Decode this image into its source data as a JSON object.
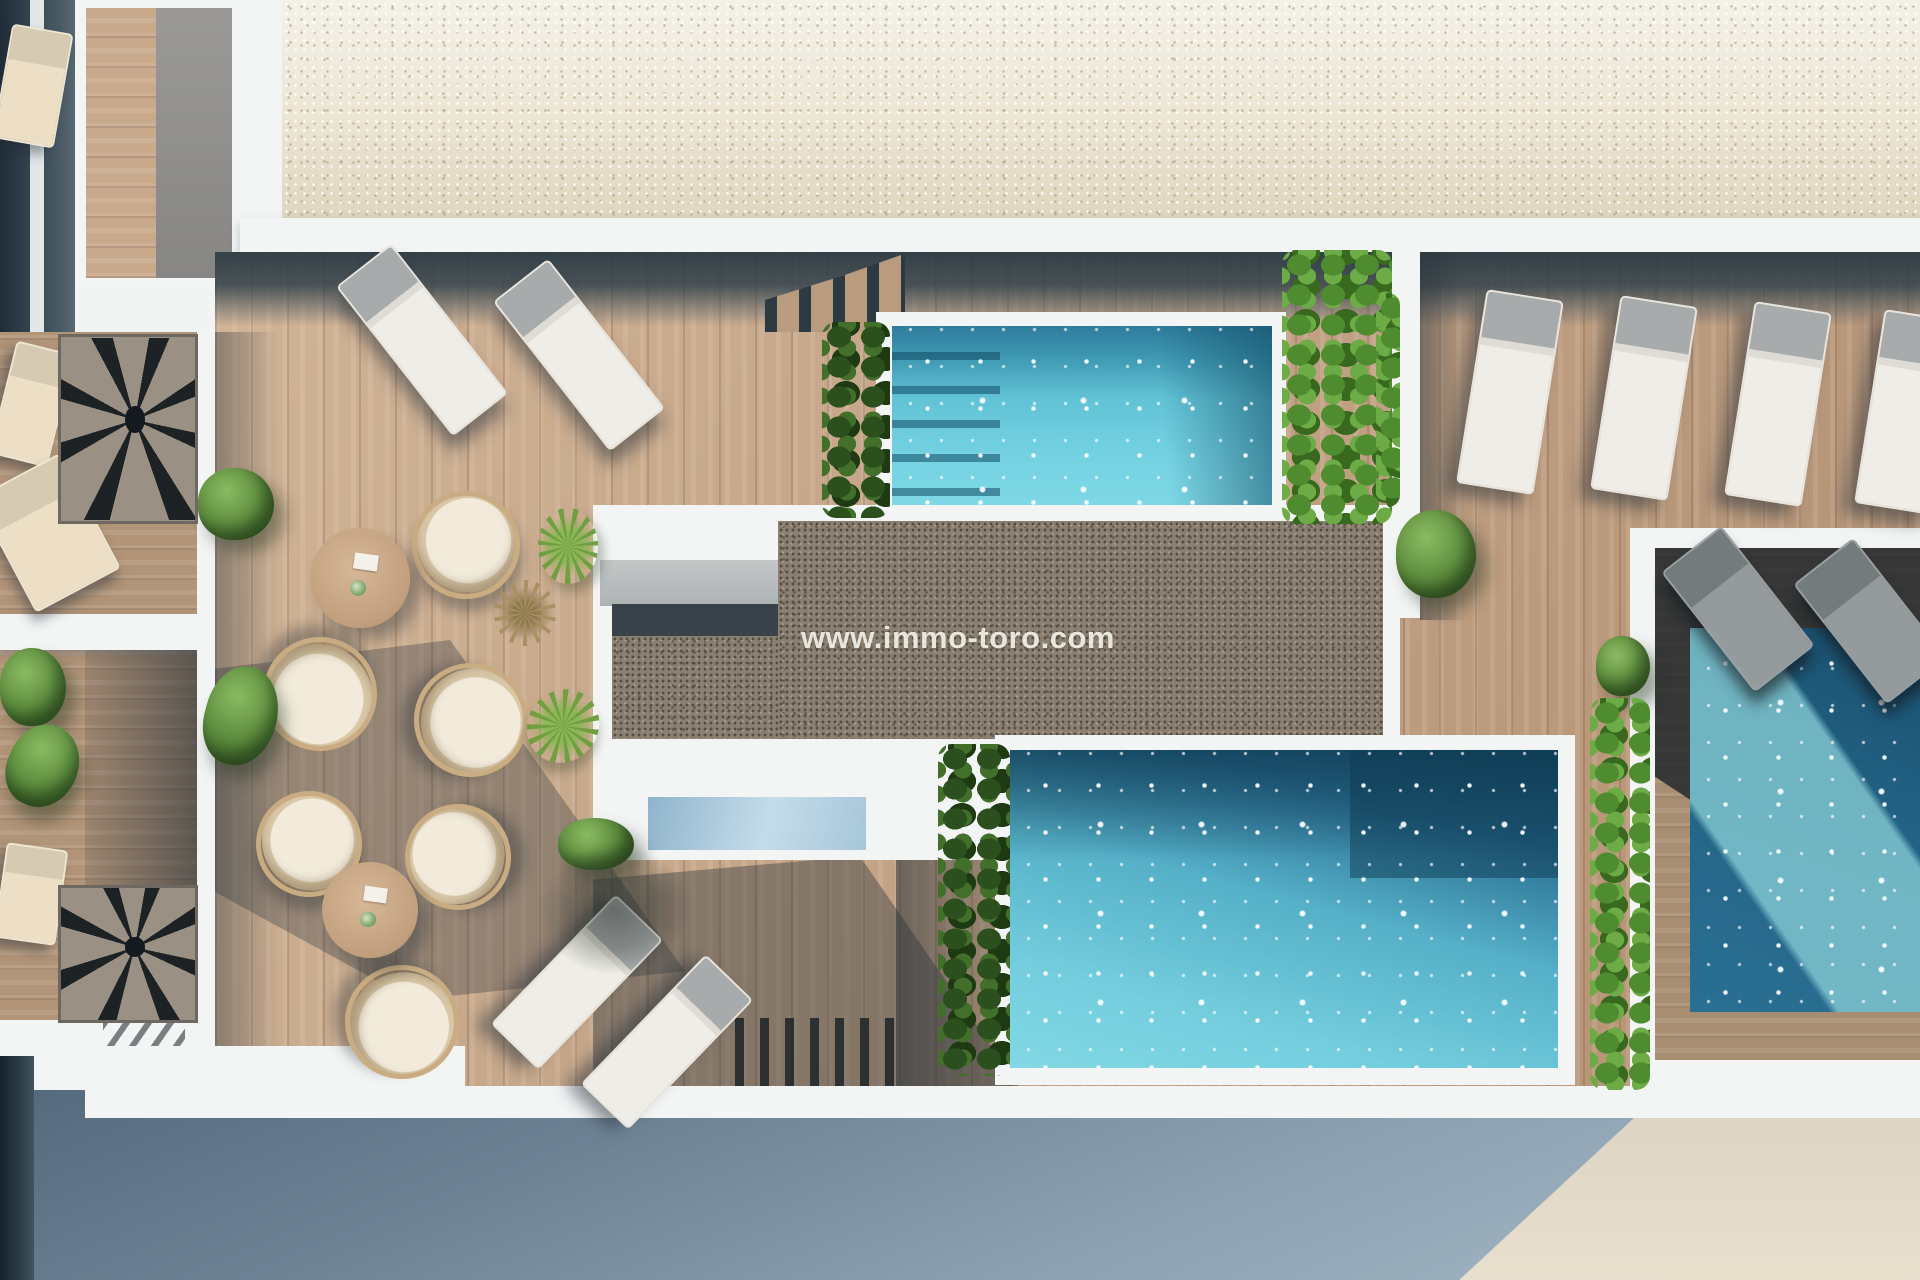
{
  "watermark": {
    "text": "www.immo-toro.com",
    "color": "#f0eee6"
  },
  "scene": {
    "type": "aerial-architectural-render",
    "subject": "rooftop terrace of an apartment building with three pools, timber sun deck, lounge furniture and planting",
    "palette": {
      "roof_gravel": "#e9e2d2",
      "terrace_gravel": "#8b8071",
      "deck_wood": "#bf9d7e",
      "white_walls": "#f3f5f5",
      "pool_light": "#74d2e2",
      "pool_mid": "#55b0c8",
      "pool_dark": "#1d5a7c",
      "shadow_blue": "#37454e",
      "street": "#7b90a1",
      "street_sunlit": "#e2d9c7",
      "plant_green": "#5a8a3c"
    },
    "counts": {
      "pools": 3,
      "sun_loungers": 14,
      "rattan_chairs": 6,
      "round_tables": 2,
      "spiral_staircases": 2
    },
    "furniture": [
      {
        "type": "lounger",
        "x": 387,
        "y": 245,
        "w": 66,
        "h": 186,
        "r": -38
      },
      {
        "type": "lounger",
        "x": 544,
        "y": 260,
        "w": 66,
        "h": 186,
        "r": -38
      },
      {
        "type": "lounger",
        "x": 1471,
        "y": 294,
        "w": 74,
        "h": 192,
        "r": 9
      },
      {
        "type": "lounger",
        "x": 1605,
        "y": 300,
        "w": 74,
        "h": 192,
        "r": 9
      },
      {
        "type": "lounger",
        "x": 1739,
        "y": 306,
        "w": 74,
        "h": 192,
        "r": 9
      },
      {
        "type": "lounger",
        "x": 1869,
        "y": 314,
        "w": 74,
        "h": 192,
        "r": 9
      },
      {
        "type": "lounger",
        "x": 544,
        "y": 892,
        "w": 62,
        "h": 176,
        "r": 44
      },
      {
        "type": "lounger",
        "x": 634,
        "y": 952,
        "w": 62,
        "h": 176,
        "r": 44
      },
      {
        "type": "lounger-gray",
        "x": 1700,
        "y": 533,
        "w": 72,
        "h": 148,
        "r": -38
      },
      {
        "type": "lounger-gray",
        "x": 1832,
        "y": 545,
        "w": 72,
        "h": 148,
        "r": -38
      },
      {
        "type": "lounger-beige",
        "x": 2,
        "y": 28,
        "w": 58,
        "h": 112,
        "r": 10
      },
      {
        "type": "lounger-beige",
        "x": 2,
        "y": 346,
        "w": 56,
        "h": 112,
        "r": 14
      },
      {
        "type": "lounger-beige",
        "x": 0,
        "y": 468,
        "w": 92,
        "h": 126,
        "r": -28
      },
      {
        "type": "lounger-beige",
        "x": 0,
        "y": 846,
        "w": 58,
        "h": 92,
        "r": 8
      },
      {
        "type": "chair",
        "x": 412,
        "y": 491,
        "w": 98,
        "h": 98,
        "r": 30
      },
      {
        "type": "chair",
        "x": 263,
        "y": 637,
        "w": 104,
        "h": 104,
        "r": 200
      },
      {
        "type": "chair",
        "x": 414,
        "y": 663,
        "w": 104,
        "h": 104,
        "r": 120
      },
      {
        "type": "chair",
        "x": 256,
        "y": 791,
        "w": 96,
        "h": 96,
        "r": 40
      },
      {
        "type": "chair",
        "x": 405,
        "y": 804,
        "w": 96,
        "h": 96,
        "r": 310
      },
      {
        "type": "chair",
        "x": 345,
        "y": 965,
        "w": 104,
        "h": 104,
        "r": 160
      },
      {
        "type": "table",
        "x": 310,
        "y": 528,
        "w": 100,
        "h": 100,
        "r": 0
      },
      {
        "type": "table",
        "x": 322,
        "y": 862,
        "w": 96,
        "h": 96,
        "r": 0
      },
      {
        "type": "bush",
        "x": 198,
        "y": 468,
        "w": 76,
        "h": 72,
        "r": 0
      },
      {
        "type": "bush",
        "x": 205,
        "y": 666,
        "w": 72,
        "h": 100,
        "r": 15
      },
      {
        "type": "bush",
        "x": 558,
        "y": 818,
        "w": 76,
        "h": 52,
        "r": 0
      },
      {
        "type": "bush",
        "x": 1396,
        "y": 510,
        "w": 80,
        "h": 88,
        "r": 0
      },
      {
        "type": "bush",
        "x": 1596,
        "y": 636,
        "w": 54,
        "h": 60,
        "r": 0
      },
      {
        "type": "bush",
        "x": 0,
        "y": 648,
        "w": 66,
        "h": 78,
        "r": 0
      },
      {
        "type": "bush",
        "x": 8,
        "y": 724,
        "w": 70,
        "h": 84,
        "r": 25
      },
      {
        "type": "yucca",
        "x": 538,
        "y": 508,
        "w": 60,
        "h": 76,
        "r": 0
      },
      {
        "type": "yucca",
        "x": 528,
        "y": 688,
        "w": 70,
        "h": 76,
        "r": 40
      },
      {
        "type": "grass",
        "x": 494,
        "y": 580,
        "w": 62,
        "h": 66,
        "r": 0
      },
      {
        "type": "vine-dark",
        "x": 822,
        "y": 322,
        "w": 68,
        "h": 196,
        "r": 0
      },
      {
        "type": "vine",
        "x": 1282,
        "y": 250,
        "w": 110,
        "h": 274,
        "r": 0
      },
      {
        "type": "vine",
        "x": 1376,
        "y": 293,
        "w": 24,
        "h": 214,
        "r": 0
      },
      {
        "type": "vine-dark",
        "x": 938,
        "y": 744,
        "w": 72,
        "h": 332,
        "r": 0
      },
      {
        "type": "vine",
        "x": 1590,
        "y": 698,
        "w": 60,
        "h": 392,
        "r": 0
      },
      {
        "type": "spiral",
        "x": 58,
        "y": 334,
        "w": 140,
        "h": 190,
        "r": 0
      },
      {
        "type": "spiral",
        "x": 58,
        "y": 885,
        "w": 140,
        "h": 138,
        "r": 0
      },
      {
        "type": "shade",
        "x": 540,
        "y": 845,
        "w": 150,
        "h": 130,
        "r": 0
      }
    ]
  }
}
